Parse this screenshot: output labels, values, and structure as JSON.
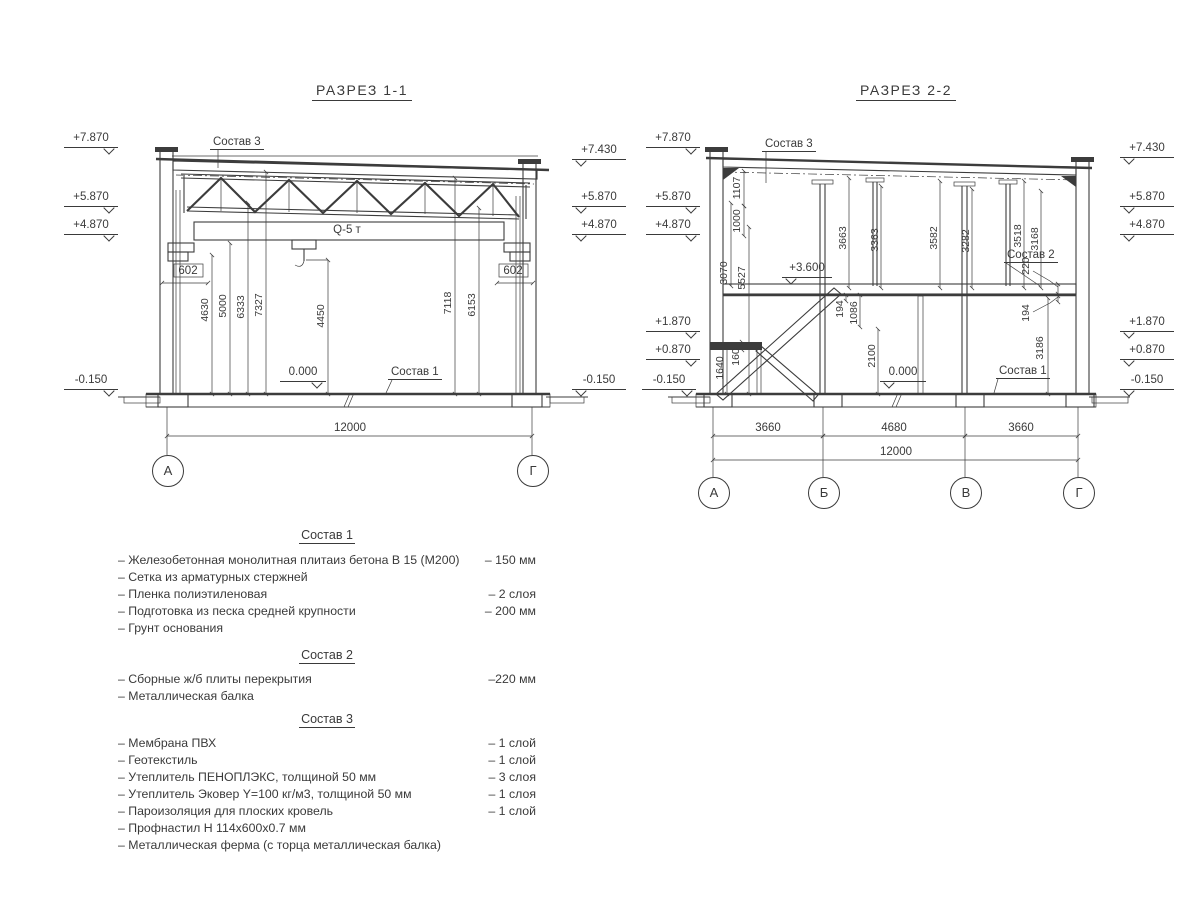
{
  "s1": {
    "title": "РАЗРЕЗ 1-1",
    "elev_left": [
      "+7.870",
      "+5.870",
      "+4.870",
      "-0.150"
    ],
    "elev_right": [
      "+7.430",
      "+5.870",
      "+4.870",
      "-0.150"
    ],
    "corbel_left": "602",
    "corbel_right": "602",
    "dims": [
      "4630",
      "5000",
      "6333",
      "7327",
      "4450",
      "7118",
      "6153"
    ],
    "crane": "Q-5 т",
    "zero": "0.000",
    "lbl_sostav3": "Состав 3",
    "lbl_sostav1": "Состав 1",
    "total": "12000",
    "axes": [
      "А",
      "Г"
    ]
  },
  "s2": {
    "title": "РАЗРЕЗ 2-2",
    "elev_left": [
      "+7.870",
      "+5.870",
      "+4.870",
      "+1.870",
      "+0.870",
      "-0.150"
    ],
    "elev_right": [
      "+7.430",
      "+5.870",
      "+4.870",
      "+1.870",
      "+0.870",
      "-0.150"
    ],
    "lvl360": "+3.600",
    "zero": "0.000",
    "lbl_sostav3": "Состав 3",
    "lbl_sostav2": "Состав 2",
    "lbl_sostav1": "Состав 1",
    "dims": [
      "1107",
      "1000",
      "3070",
      "5527",
      "1640",
      "160",
      "3663",
      "3363",
      "194",
      "1086",
      "2100",
      "3582",
      "3282",
      "3518",
      "3168",
      "220",
      "194",
      "3186"
    ],
    "spans": [
      "3660",
      "4680",
      "3660"
    ],
    "total": "12000",
    "axes": [
      "А",
      "Б",
      "В",
      "Г"
    ]
  },
  "comp": [
    {
      "title": "Состав 1",
      "items": [
        {
          "n": "– Железобетонная  монолитная плитаиз бетона В 15 (М200)",
          "v": "– 150 мм"
        },
        {
          "n": "– Сетка из арматурных стержней",
          "v": ""
        },
        {
          "n": "– Пленка полиэтиленовая",
          "v": "– 2 слоя"
        },
        {
          "n": "– Подготовка из песка средней крупности",
          "v": "– 200 мм"
        },
        {
          "n": "– Грунт основания",
          "v": ""
        }
      ]
    },
    {
      "title": "Состав 2",
      "items": [
        {
          "n": "– Сборные ж/б плиты перекрытия",
          "v": "–220 мм"
        },
        {
          "n": "– Металлическая балка",
          "v": ""
        }
      ]
    },
    {
      "title": "Состав 3",
      "items": [
        {
          "n": "– Мембрана ПВХ",
          "v": "– 1 слой"
        },
        {
          "n": "– Геотекстиль",
          "v": "– 1 слой"
        },
        {
          "n": "– Утеплитель ПЕНОПЛЭКС, толщиной 50 мм",
          "v": "– 3 слоя"
        },
        {
          "n": "– Утеплитель Эковер Y=100 кг/м3, толщиной 50 мм",
          "v": "– 1 слоя"
        },
        {
          "n": "– Пароизоляция для плоских кровель",
          "v": "– 1 слой"
        },
        {
          "n": "– Профнастил Н 114х600х0.7 мм",
          "v": ""
        },
        {
          "n": "– Металлическая ферма (с торца металлическая балка)",
          "v": ""
        }
      ]
    }
  ]
}
